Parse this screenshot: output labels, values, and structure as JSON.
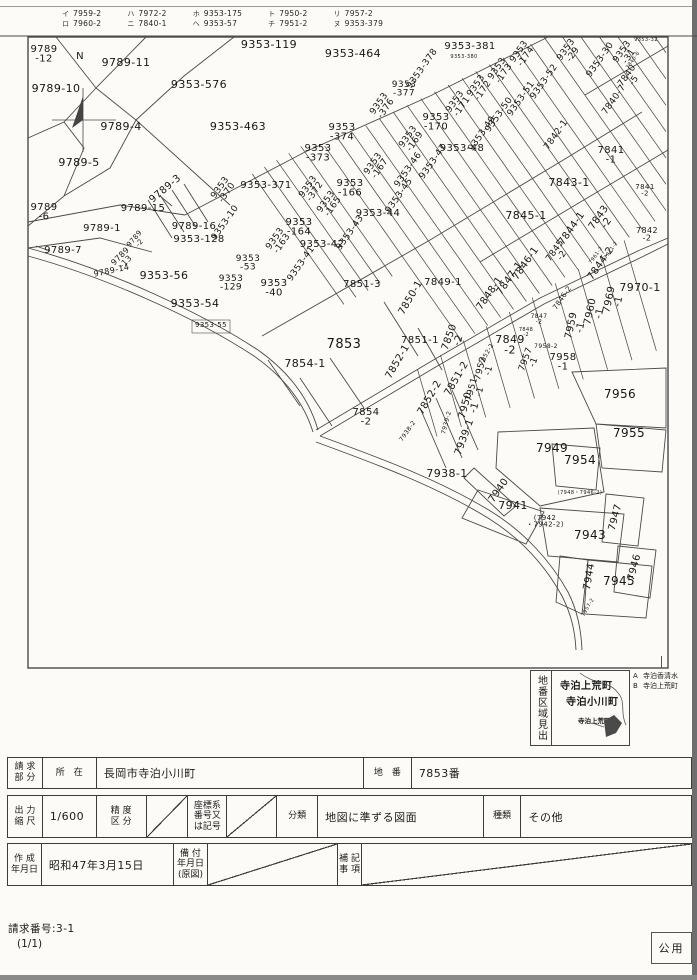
{
  "page": {
    "request_no": "請求番号:3-1",
    "page_indicator": "(1/1)",
    "stamp": "公用"
  },
  "legend": {
    "groups": [
      {
        "rows": [
          [
            "イ",
            "7959-2"
          ],
          [
            "ロ",
            "7960-2"
          ]
        ]
      },
      {
        "rows": [
          [
            "ハ",
            "7972-2"
          ],
          [
            "ニ",
            "7840-1"
          ]
        ]
      },
      {
        "rows": [
          [
            "ホ",
            "9353-175"
          ],
          [
            "ヘ",
            "9353-57"
          ]
        ]
      },
      {
        "rows": [
          [
            "ト",
            "7950-2"
          ],
          [
            "チ",
            "7951-2"
          ]
        ]
      },
      {
        "rows": [
          [
            "リ",
            "7957-2"
          ],
          [
            "ヌ",
            "9353-379"
          ]
        ]
      }
    ]
  },
  "map": {
    "north_mark": "N",
    "parcels": [
      [
        "9789|-12",
        44,
        52,
        0,
        10
      ],
      [
        "9789-11",
        126,
        66,
        0,
        11
      ],
      [
        "9789-10",
        56,
        92,
        0,
        11
      ],
      [
        "9789-4",
        121,
        130,
        0,
        11
      ],
      [
        "9789-5",
        79,
        166,
        0,
        11
      ],
      [
        "9353-576",
        199,
        88,
        0,
        11
      ],
      [
        "9353-463",
        238,
        130,
        0,
        11
      ],
      [
        "9353-119",
        269,
        48,
        0,
        11
      ],
      [
        "9353-464",
        353,
        57,
        0,
        11
      ],
      [
        "9789|-6",
        44,
        210,
        0,
        10
      ],
      [
        "9789-1",
        102,
        231,
        0,
        10
      ],
      [
        "9789-7",
        63,
        253,
        0,
        10
      ],
      [
        "9789-15",
        143,
        211,
        0,
        10
      ],
      [
        "9789-3",
        167,
        191,
        -40,
        10
      ],
      [
        "9353|-370",
        222,
        189,
        -55,
        9
      ],
      [
        "9353-10",
        227,
        224,
        -55,
        9
      ],
      [
        "9789-16",
        194,
        229,
        0,
        10
      ],
      [
        "9353-128",
        199,
        242,
        0,
        10
      ],
      [
        "9789|-2",
        136,
        240,
        -50,
        7
      ],
      [
        "9789|-13",
        122,
        258,
        -45,
        8
      ],
      [
        "9789-14",
        112,
        273,
        -12,
        8
      ],
      [
        "9353-56",
        164,
        279,
        0,
        11
      ],
      [
        "9353|-129",
        231,
        281,
        0,
        9
      ],
      [
        "9353|-53",
        248,
        261,
        0,
        9
      ],
      [
        "9353-54",
        195,
        307,
        0,
        11
      ],
      [
        "9353-55",
        211,
        327,
        0,
        7
      ],
      [
        "9353|-40",
        274,
        286,
        0,
        10
      ],
      [
        "9353-41",
        303,
        265,
        -55,
        9
      ],
      [
        "9353-42",
        322,
        247,
        0,
        10
      ],
      [
        "9353-43",
        352,
        234,
        -55,
        9
      ],
      [
        "9353|-164",
        299,
        225,
        0,
        10
      ],
      [
        "9353|-163",
        277,
        240,
        -55,
        9
      ],
      [
        "9353-371",
        266,
        188,
        0,
        10
      ],
      [
        "9353|-372",
        310,
        188,
        -55,
        9
      ],
      [
        "9353|-373",
        318,
        151,
        0,
        10
      ],
      [
        "9353|-374",
        342,
        130,
        0,
        10
      ],
      [
        "9353|-165",
        328,
        203,
        -55,
        9
      ],
      [
        "9353|-166",
        350,
        186,
        0,
        10
      ],
      [
        "9353|-167",
        375,
        165,
        -55,
        9
      ],
      [
        "9353-44",
        378,
        216,
        0,
        10
      ],
      [
        "9353-45",
        401,
        197,
        -55,
        9
      ],
      [
        "9353-46",
        410,
        171,
        -55,
        9
      ],
      [
        "9353-47",
        435,
        163,
        -55,
        9
      ],
      [
        "9353-48",
        462,
        151,
        0,
        10
      ],
      [
        "9353-49",
        484,
        135,
        -55,
        9
      ],
      [
        "9353-50",
        501,
        116,
        -55,
        9
      ],
      [
        "9353-51",
        523,
        100,
        -55,
        9
      ],
      [
        "9353-52",
        546,
        83,
        -55,
        9
      ],
      [
        "9353|-377",
        404,
        87,
        0,
        9
      ],
      [
        "9353|-376",
        381,
        105,
        -55,
        9
      ],
      [
        "9353-378",
        424,
        70,
        -55,
        9
      ],
      [
        "9353-381",
        470,
        49,
        0,
        10
      ],
      [
        "9353-380",
        464,
        58,
        0,
        5
      ],
      [
        "9353|-174",
        521,
        53,
        -55,
        9
      ],
      [
        "9353|-173",
        499,
        70,
        -55,
        9
      ],
      [
        "9353|-172",
        478,
        87,
        -55,
        9
      ],
      [
        "9353|-171",
        457,
        103,
        -55,
        9
      ],
      [
        "9353|-170",
        436,
        120,
        0,
        10
      ],
      [
        "9353|-169",
        410,
        138,
        -55,
        9
      ],
      [
        "9353|-29",
        568,
        51,
        -55,
        9
      ],
      [
        "9353-30",
        602,
        61,
        -55,
        9
      ],
      [
        "9353|-31",
        624,
        53,
        -55,
        9
      ],
      [
        "9353-32",
        646,
        41,
        0,
        5
      ],
      [
        "7840|-5",
        629,
        77,
        -55,
        9
      ],
      [
        "7840-6",
        634,
        61,
        -55,
        5
      ],
      [
        "7840-7",
        616,
        101,
        -55,
        9
      ],
      [
        "7842-1",
        558,
        136,
        -55,
        9
      ],
      [
        "7841|-1",
        611,
        153,
        0,
        10
      ],
      [
        "7843-1",
        569,
        186,
        0,
        11
      ],
      [
        "7841|-2",
        645,
        189,
        0,
        7
      ],
      [
        "7845-1",
        526,
        219,
        0,
        11
      ],
      [
        "7844-1",
        574,
        230,
        -55,
        10
      ],
      [
        "7843|-2",
        601,
        219,
        -55,
        10
      ],
      [
        "7842|-2",
        647,
        233,
        0,
        8
      ],
      [
        "7845|-2",
        557,
        252,
        -55,
        9
      ],
      [
        "7846-1",
        528,
        265,
        -55,
        10
      ],
      [
        "7844-2",
        603,
        265,
        -55,
        10
      ],
      [
        "7847-1",
        512,
        280,
        -55,
        10
      ],
      [
        "7848-1",
        492,
        295,
        -55,
        10
      ],
      [
        "7970-1",
        640,
        291,
        0,
        11
      ],
      [
        "7969|-1",
        612,
        300,
        -78,
        10
      ],
      [
        "7960|-1",
        593,
        312,
        -78,
        10
      ],
      [
        "7959|-1",
        574,
        326,
        -78,
        10
      ],
      [
        "7961-2",
        597,
        256,
        -55,
        5
      ],
      [
        "7971-2",
        612,
        251,
        -55,
        5
      ],
      [
        "7846-2",
        564,
        299,
        -55,
        7
      ],
      [
        "7847|-2",
        539,
        318,
        0,
        6
      ],
      [
        "7848|-2",
        526,
        331,
        0,
        5
      ],
      [
        "7849|-2",
        510,
        343,
        0,
        11
      ],
      [
        "7958-2",
        546,
        348,
        0,
        6
      ],
      [
        "7957|-1",
        528,
        360,
        -70,
        9
      ],
      [
        "7958|-1",
        563,
        360,
        0,
        10
      ],
      [
        "7952-2",
        488,
        355,
        -60,
        6
      ],
      [
        "7952|-1",
        483,
        369,
        -75,
        9
      ],
      [
        "7951|-1",
        474,
        390,
        -75,
        9
      ],
      [
        "7851-3",
        362,
        287,
        0,
        10
      ],
      [
        "7850-1",
        413,
        299,
        -60,
        10
      ],
      [
        "7849-1",
        443,
        285,
        0,
        10
      ],
      [
        "7851-1",
        420,
        343,
        0,
        10
      ],
      [
        "7850|-2",
        452,
        338,
        -70,
        10
      ],
      [
        "7852-1",
        400,
        363,
        -60,
        10
      ],
      [
        "7852-2",
        432,
        399,
        -60,
        10
      ],
      [
        "7851-2",
        459,
        380,
        -60,
        10
      ],
      [
        "7950|-1",
        468,
        406,
        -75,
        10
      ],
      [
        "7853",
        344,
        348,
        0,
        13
      ],
      [
        "7854-1",
        305,
        367,
        0,
        11
      ],
      [
        "7854|-2",
        366,
        415,
        0,
        10
      ],
      [
        "7938-2",
        409,
        432,
        -55,
        6
      ],
      [
        "7939-2",
        448,
        423,
        -75,
        6
      ],
      [
        "7939-1",
        467,
        438,
        -70,
        10
      ],
      [
        "7938-1",
        447,
        477,
        0,
        11
      ],
      [
        "7956",
        620,
        398,
        0,
        12
      ],
      [
        "7955",
        629,
        437,
        0,
        12
      ],
      [
        "7949",
        552,
        452,
        0,
        12
      ],
      [
        "7954",
        580,
        464,
        0,
        12
      ],
      [
        "7940",
        501,
        492,
        -55,
        10
      ],
      [
        "7941",
        513,
        509,
        0,
        11
      ],
      [
        "(7942|・7942-2)",
        545,
        520,
        0,
        7
      ],
      [
        "7943",
        590,
        539,
        0,
        12
      ],
      [
        "7947",
        618,
        518,
        -75,
        10
      ],
      [
        "7946",
        637,
        568,
        -75,
        10
      ],
      [
        "7944",
        592,
        577,
        -80,
        10
      ],
      [
        "7945",
        619,
        585,
        0,
        12
      ],
      [
        "(7948・7946-2)",
        580,
        494,
        0,
        5
      ],
      [
        "7957-2",
        589,
        608,
        -60,
        5
      ],
      [
        "N",
        80,
        59,
        0,
        10
      ]
    ]
  },
  "inset": {
    "side_label": "地番区域見出",
    "town_1": "寺泊上荒町",
    "town_2": "寺泊小川町",
    "pointer_label": "寺泊上荒町"
  },
  "edge_legend": {
    "items": [
      [
        "A",
        "寺泊香清水"
      ],
      [
        "B",
        "寺泊上荒町"
      ]
    ]
  },
  "table": {
    "r1": {
      "l1": "請 求\n部 分",
      "l2": "所　在",
      "v1": "長岡市寺泊小川町",
      "l3": "地　番",
      "v2": "7853番"
    },
    "r2": {
      "l1": "出 力\n縮 尺",
      "v1": "1/600",
      "l2": "精 度\n区 分",
      "l3": "座標系\n番号又\nは記号",
      "l4": "分類",
      "v2": "地図に準ずる図面",
      "l5": "種類",
      "v3": "その他"
    },
    "r3": {
      "l1": "作 成\n年月日",
      "v1": "昭和47年3月15日",
      "l2": "備 付\n年月日\n(原図)",
      "l3": "補 記\n事 項"
    }
  }
}
